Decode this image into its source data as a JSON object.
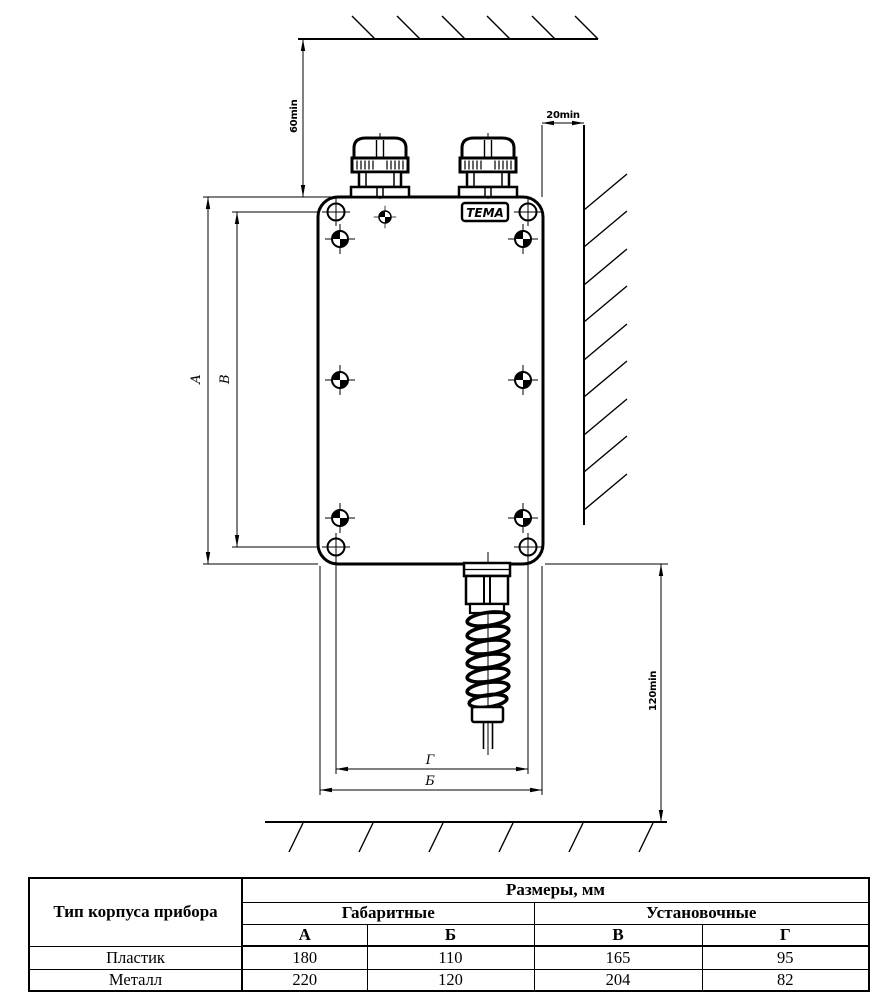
{
  "drawing": {
    "brand_label": "ТЕМА",
    "colors": {
      "line": "#000000",
      "background": "#ffffff"
    },
    "dims": {
      "ceiling_clearance": "60min",
      "wall_clearance": "20min",
      "floor_clearance": "120min",
      "height_outer": "А",
      "height_mounting": "В",
      "width_outer": "Б",
      "width_mounting": "Г"
    }
  },
  "table": {
    "col1_header": "Тип корпуса прибора",
    "sizes_header": "Размеры, мм",
    "group_headers": [
      "Габаритные",
      "Установочные"
    ],
    "dim_headers": [
      "А",
      "Б",
      "В",
      "Г"
    ],
    "rows": [
      {
        "type": "Пластик",
        "values": [
          "180",
          "110",
          "165",
          "95"
        ]
      },
      {
        "type": "Металл",
        "values": [
          "220",
          "120",
          "204",
          "82"
        ]
      }
    ]
  }
}
